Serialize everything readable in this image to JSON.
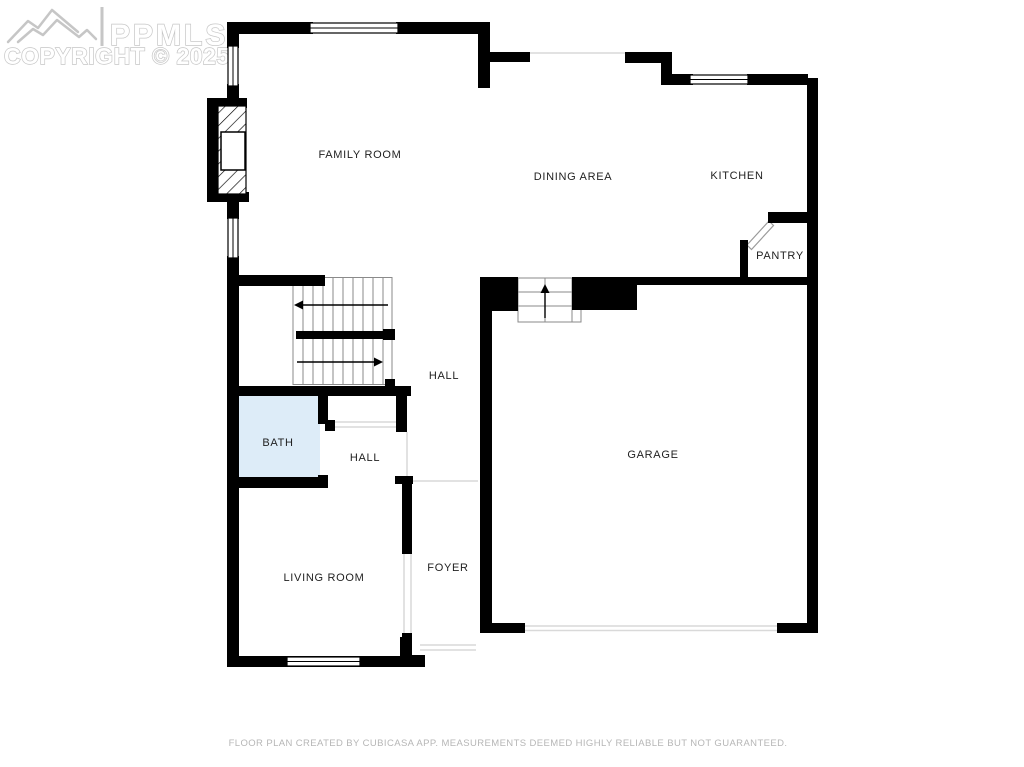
{
  "watermark": {
    "brand": "PPMLS",
    "copyright": "COPYRIGHT © 2025"
  },
  "rooms": {
    "family_room": {
      "label": "FAMILY ROOM"
    },
    "dining_area": {
      "label": "DINING AREA"
    },
    "kitchen": {
      "label": "KITCHEN"
    },
    "pantry": {
      "label": "PANTRY"
    },
    "hall_upper": {
      "label": "HALL"
    },
    "bath": {
      "label": "BATH"
    },
    "hall_lower": {
      "label": "HALL"
    },
    "garage": {
      "label": "GARAGE"
    },
    "living_room": {
      "label": "LIVING ROOM"
    },
    "foyer": {
      "label": "FOYER"
    }
  },
  "footer": {
    "disclaimer": "FLOOR PLAN CREATED BY CUBICASA APP. MEASUREMENTS DEEMED HIGHLY RELIABLE BUT NOT GUARANTEED."
  },
  "colors": {
    "wall": "#000000",
    "bath_fill": "#ddecf8",
    "label_text": "#1f1f1f",
    "watermark": "#c6c6c6",
    "footer_text": "#b6b6b6",
    "opening_line": "#d9d9d9",
    "stair_line": "#8a8a8a",
    "background": "#ffffff"
  }
}
